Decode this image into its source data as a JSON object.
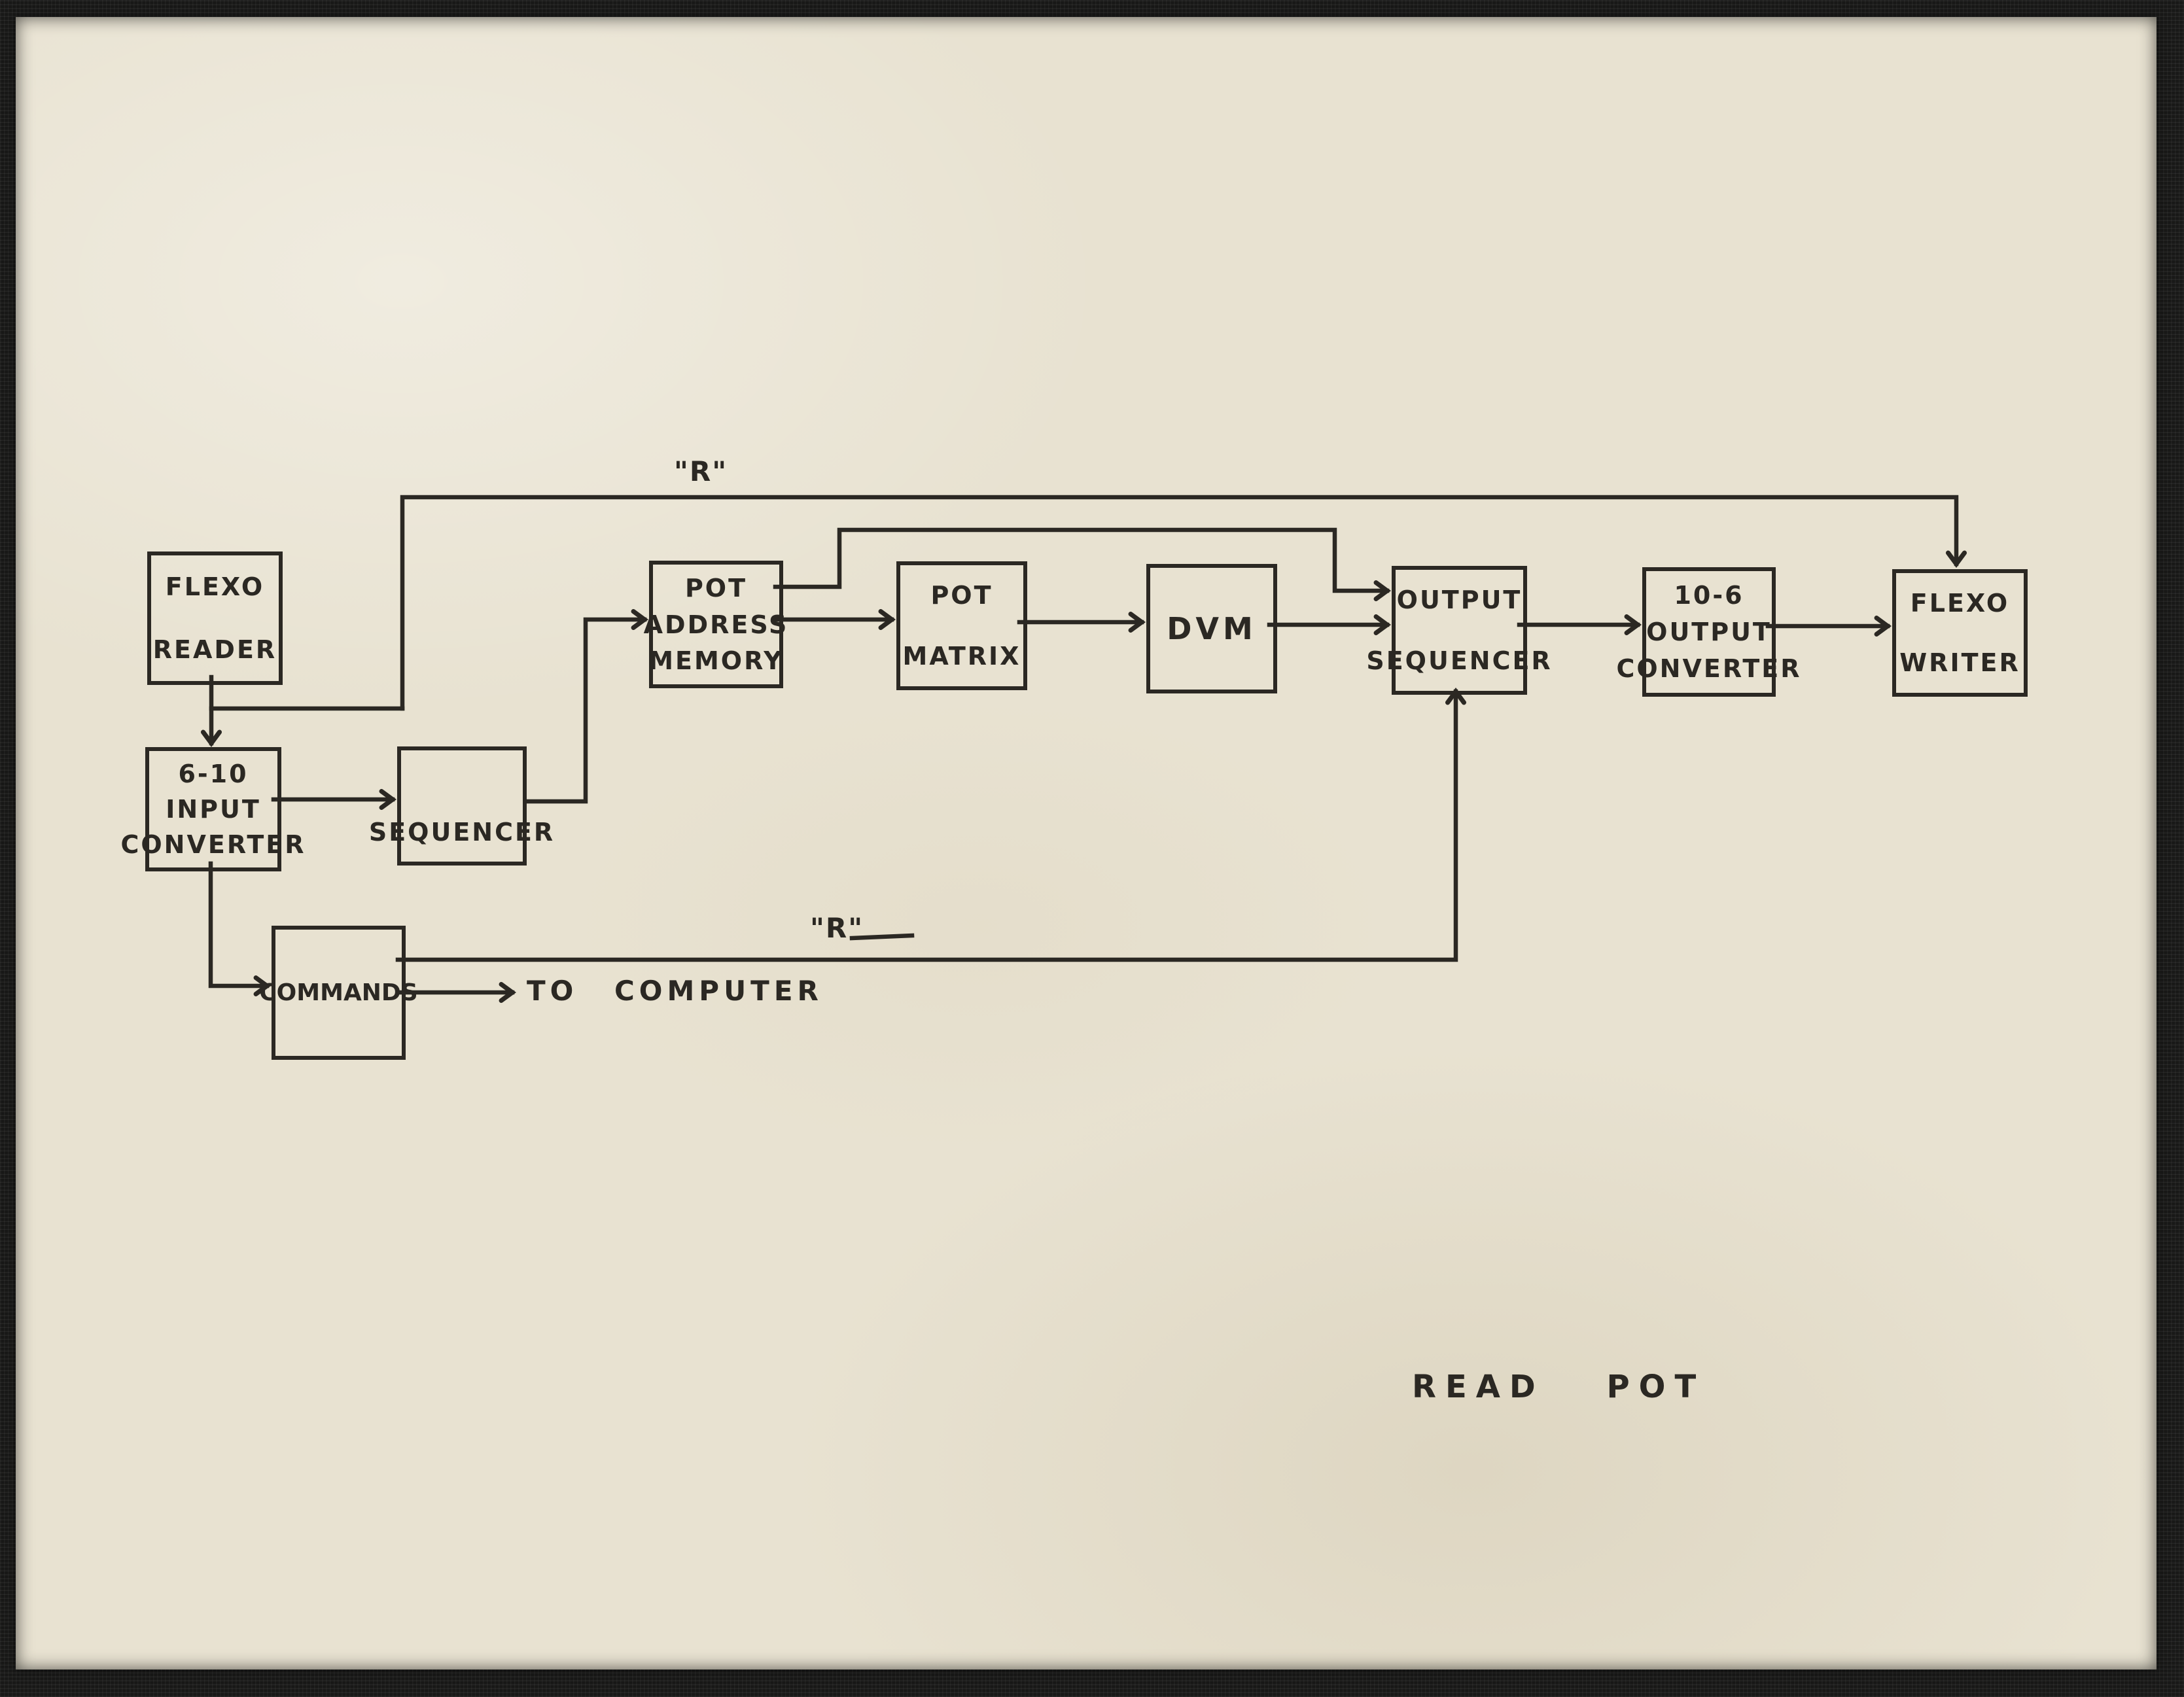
{
  "diagram": {
    "caption": "READ POT",
    "nodes": {
      "flexo_reader": {
        "lines": [
          "FLEXO",
          "READER"
        ]
      },
      "input_converter": {
        "lines": [
          "6-10",
          "INPUT",
          "CONVERTER"
        ]
      },
      "sequencer": {
        "lines": [
          "SEQUENCER"
        ]
      },
      "pot_address_memory": {
        "lines": [
          "POT",
          "ADDRESS",
          "MEMORY"
        ]
      },
      "pot_matrix": {
        "lines": [
          "POT",
          "MATRIX"
        ]
      },
      "dvm": {
        "lines": [
          "DVM"
        ]
      },
      "output_sequencer": {
        "lines": [
          "OUTPUT",
          "SEQUENCER"
        ]
      },
      "output_converter": {
        "lines": [
          "10-6",
          "OUTPUT",
          "CONVERTER"
        ]
      },
      "flexo_writer": {
        "lines": [
          "FLEXO",
          "WRITER"
        ]
      },
      "commands": {
        "lines": [
          "COMMANDS"
        ]
      }
    },
    "labels": {
      "r_top": "\"R\"",
      "r_mid": "\"R\"",
      "to_computer": "TO COMPUTER"
    },
    "colors": {
      "ink": "#2b2823",
      "paper": "#e8e2d1",
      "mat_border": "#181817"
    }
  }
}
